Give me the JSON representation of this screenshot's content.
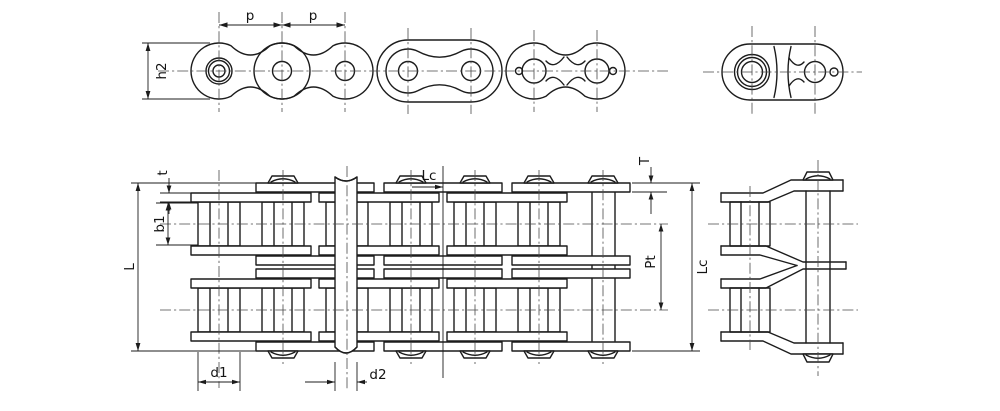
{
  "colors": {
    "line": "#1c1c1c",
    "background": "#ffffff",
    "centerline": "#4a4a4a"
  },
  "labels": {
    "pitch_1": "p",
    "pitch_2": "p",
    "plate_height": "h2",
    "inner_plate_thickness": "t",
    "inner_width": "b1",
    "pin_length": "L",
    "roller_diameter": "d1",
    "pin_diameter": "d2",
    "connecting_pin_length_top": "Lc",
    "outer_plate_thickness": "T",
    "transverse_pitch": "Pt",
    "connecting_pin_length_right": "Lc"
  }
}
